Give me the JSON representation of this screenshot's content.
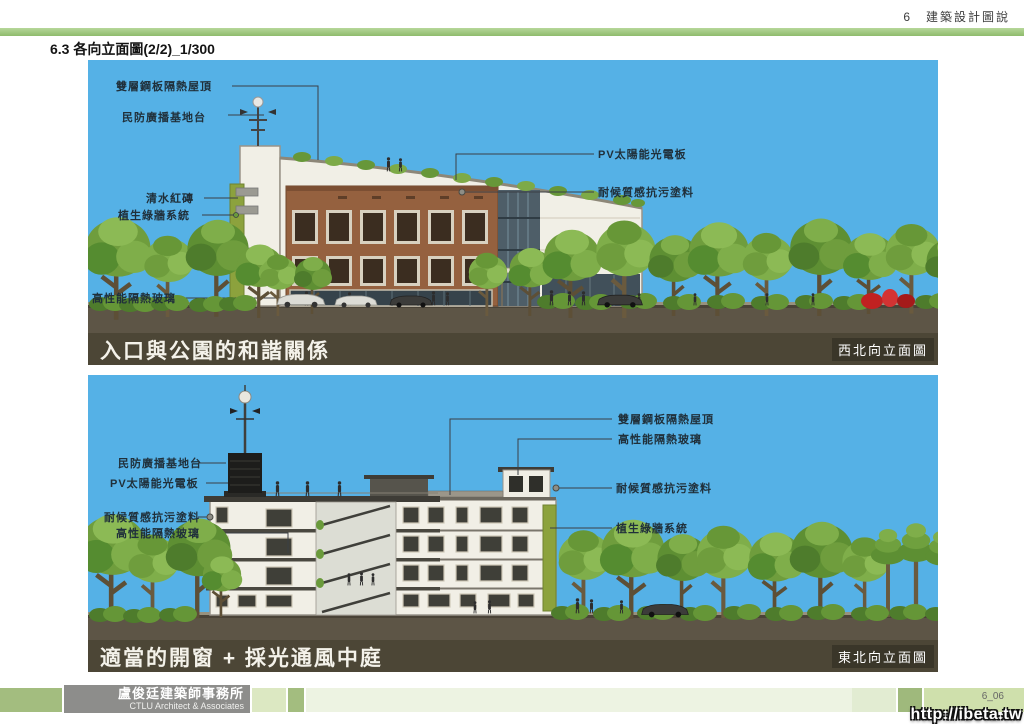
{
  "header": {
    "page_label": "6　建築設計圖說",
    "section_title": "6.3  各向立面圖(2/2)_1/300"
  },
  "panels": [
    {
      "caption": "入口與公園的和諧關係",
      "elevation_label": "西北向立面圖",
      "annotations": [
        {
          "text": "雙層鋼板隔熱屋頂"
        },
        {
          "text": "民防廣播基地台"
        },
        {
          "text": "清水紅磚"
        },
        {
          "text": "植生綠牆系統"
        },
        {
          "text": "高性能隔熱玻璃"
        },
        {
          "text": "PV太陽能光電板"
        },
        {
          "text": "耐候質感抗污塗料"
        }
      ]
    },
    {
      "caption": "適當的開窗 + 採光通風中庭",
      "elevation_label": "東北向立面圖",
      "annotations": [
        {
          "text": "民防廣播基地台"
        },
        {
          "text": "PV太陽能光電板"
        },
        {
          "text": "耐候質感抗污塗料"
        },
        {
          "text": "高性能隔熱玻璃"
        },
        {
          "text": "雙層鋼板隔熱屋頂"
        },
        {
          "text": "高性能隔熱玻璃"
        },
        {
          "text": "耐候質感抗污塗料"
        },
        {
          "text": "植生綠牆系統"
        }
      ]
    }
  ],
  "footer": {
    "firm_name_zh": "盧俊廷建築師事務所",
    "firm_name_en": "CTLU  Architect & Associates",
    "page_number": "6_06",
    "watermark": "http://ibeta.tw"
  },
  "colors": {
    "accent_green": "#9fc27c",
    "sky": "#55b1e6",
    "caption_bar": "#4c4636",
    "ground": "#5d5546",
    "green_wall": "#8ca23d",
    "brick": "#95613f"
  }
}
